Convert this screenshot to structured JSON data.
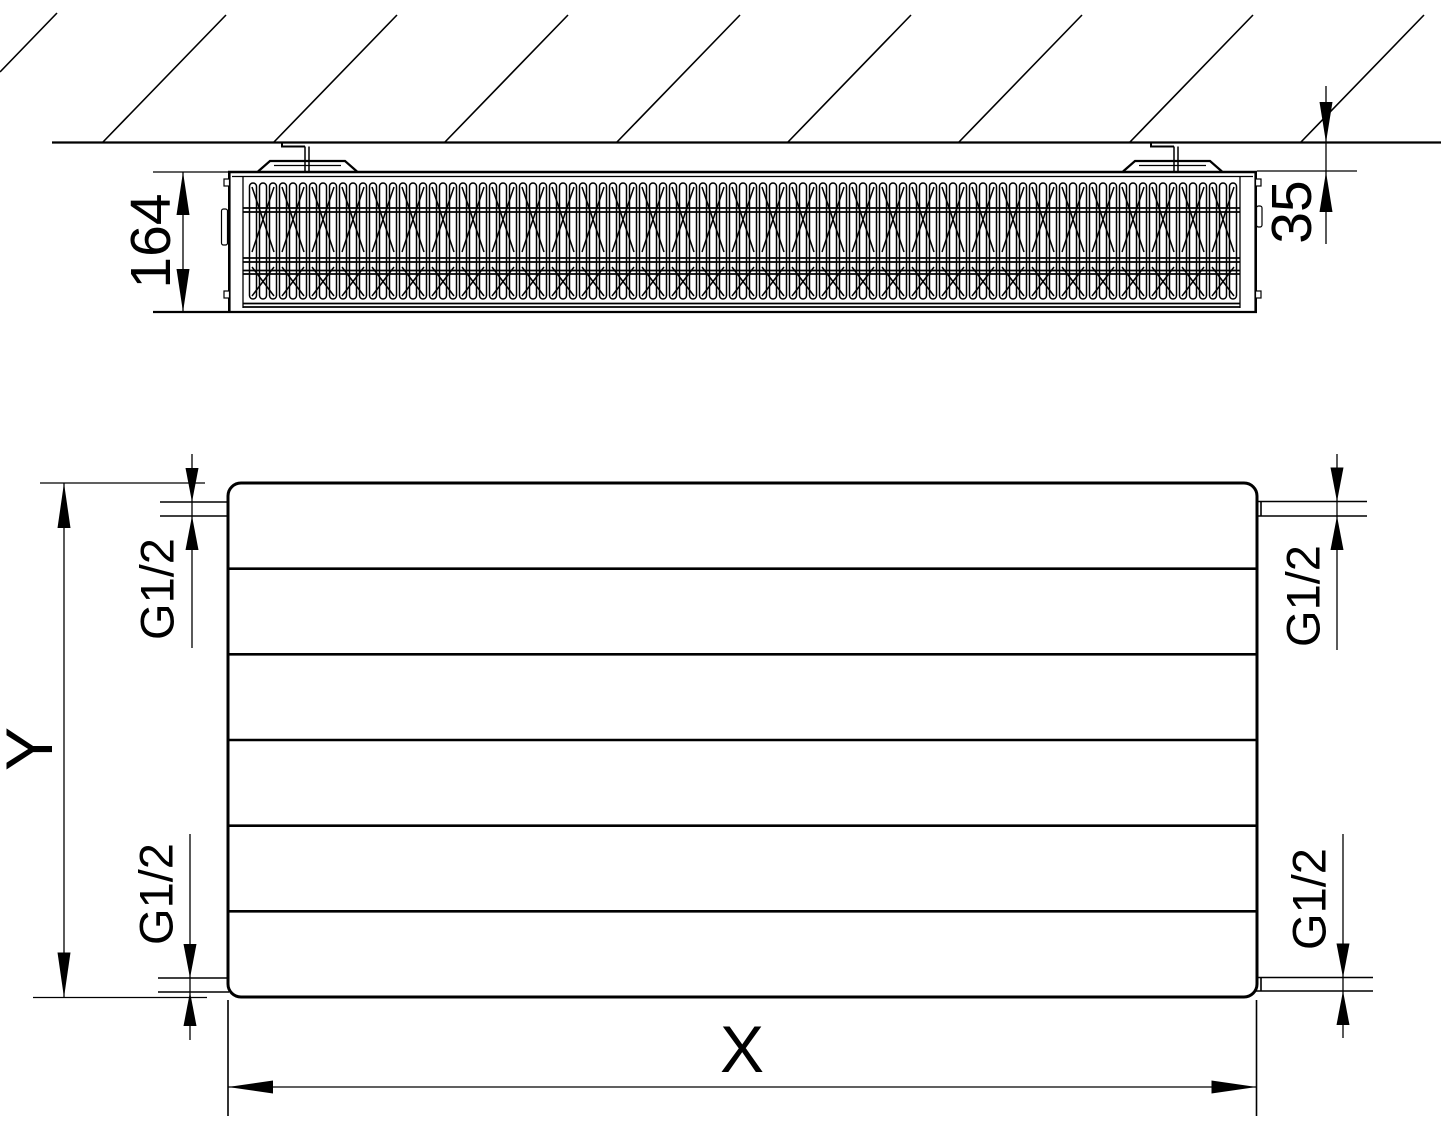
{
  "colors": {
    "line": "#000000",
    "background": "#ffffff"
  },
  "top_view": {
    "depth_label": "164",
    "wall_distance_label": "35"
  },
  "front_view": {
    "height_label": "Y",
    "width_label": "X",
    "connections": {
      "top_left": "G1/2",
      "top_right": "G1/2",
      "bottom_left": "G1/2",
      "bottom_right": "G1/2"
    }
  }
}
